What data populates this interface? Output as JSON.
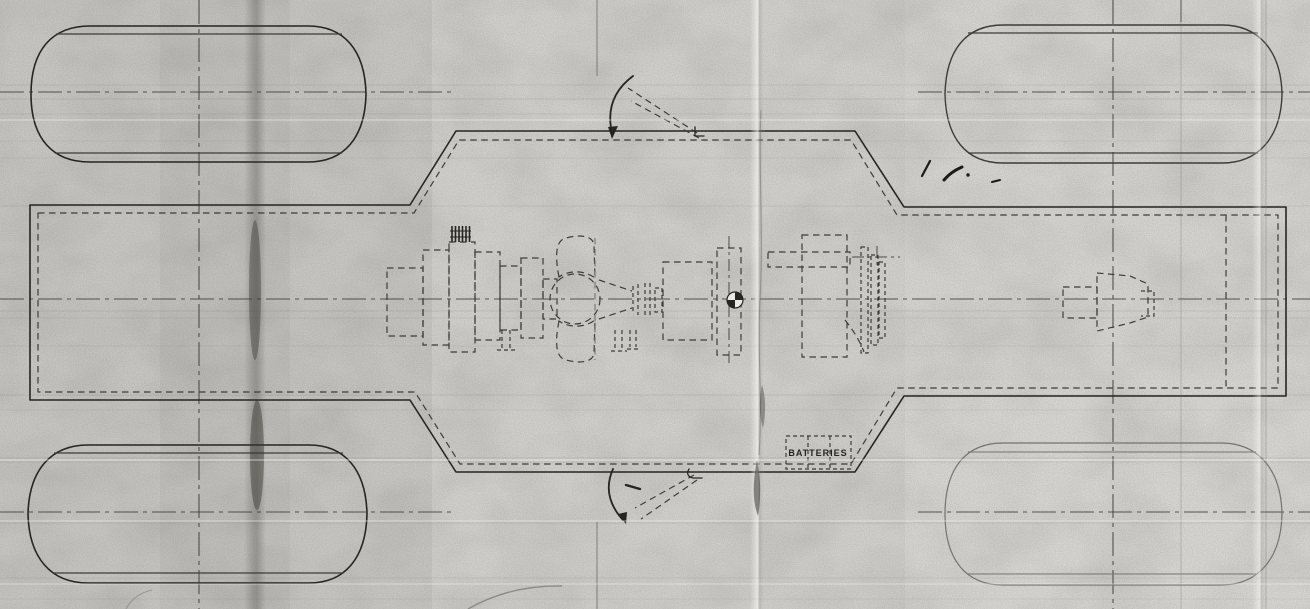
{
  "theme": {
    "paper": "#d4d3cf",
    "ink-strong": "#262520",
    "ink": "#3d3c36",
    "ink-light": "#74736b",
    "crease-dark": "#36352f",
    "highlight": "#f4f3ee"
  },
  "drawing": {
    "battery_label": "BATTERIES"
  }
}
